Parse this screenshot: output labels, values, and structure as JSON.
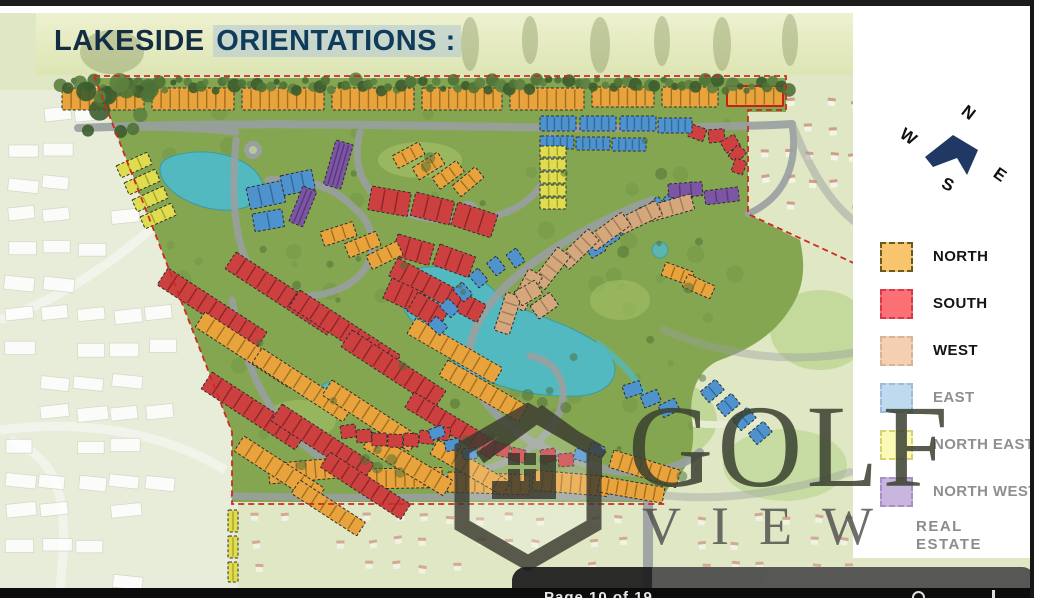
{
  "title": {
    "prefix": "LAKESIDE",
    "suffix": "ORIENTATIONS :"
  },
  "compass": {
    "arrow_color": "#1F3864",
    "letters": [
      {
        "t": "N",
        "x": 72,
        "y": 8,
        "r": 38
      },
      {
        "t": "W",
        "x": 10,
        "y": 32,
        "r": 35
      },
      {
        "t": "S",
        "x": 52,
        "y": 80,
        "r": 25
      },
      {
        "t": "E",
        "x": 104,
        "y": 70,
        "r": 35
      }
    ]
  },
  "legend": {
    "items": [
      {
        "label": "NORTH",
        "fill": "#F8C46E",
        "border": "#6b5a20",
        "label_color": "#141414"
      },
      {
        "label": "SOUTH",
        "fill": "#FA7075",
        "border": "#d93a4a",
        "label_color": "#141414"
      },
      {
        "label": "WEST",
        "fill": "#F5CFB2",
        "border": "#dbb296",
        "label_color": "#141414"
      },
      {
        "label": "EAST",
        "fill": "#BFD9EF",
        "border": "#9cbcdb",
        "label_color": "#8f8f8f"
      },
      {
        "label": "NORTH EAST",
        "fill": "#FBF9B6",
        "border": "#d8d075",
        "label_color": "#8f8f8f"
      },
      {
        "label": "NORTH WEST",
        "fill": "#C8B6DE",
        "border": "#a98fc9",
        "label_color": "#8f8f8f"
      }
    ]
  },
  "watermark": {
    "brand_top": "GOLF",
    "brand_bottom": "VIEW",
    "tagline_line1": "REAL",
    "tagline_line2": "ESTATE"
  },
  "viewer": {
    "page_label": "Page 10 of 19"
  },
  "map": {
    "palette": {
      "n": {
        "f": "#E8A33C",
        "t": "#8f6318"
      },
      "s": {
        "f": "#CC4040",
        "t": "#7e1f1f"
      },
      "w": {
        "f": "#D4A87C",
        "t": "#96714c"
      },
      "e": {
        "f": "#4E93CE",
        "t": "#28608f"
      },
      "ne": {
        "f": "#DFDC4F",
        "t": "#9a9727"
      },
      "nw": {
        "f": "#7C55A5",
        "t": "#4e3370"
      }
    },
    "clusters": [
      [
        62,
        88,
        82,
        22,
        0,
        "n",
        9
      ],
      [
        152,
        88,
        82,
        22,
        0,
        "n",
        9
      ],
      [
        242,
        88,
        82,
        22,
        0,
        "n",
        9
      ],
      [
        332,
        88,
        82,
        22,
        0,
        "n",
        9
      ],
      [
        422,
        88,
        80,
        22,
        0,
        "n",
        9
      ],
      [
        510,
        88,
        74,
        22,
        0,
        "n",
        8
      ],
      [
        592,
        87,
        62,
        20,
        0,
        "n",
        7
      ],
      [
        662,
        87,
        56,
        20,
        0,
        "n",
        6
      ],
      [
        727,
        86,
        56,
        20,
        0,
        "n",
        6,
        1
      ],
      [
        268,
        464,
        84,
        20,
        -5,
        "n",
        9
      ],
      [
        358,
        469,
        84,
        20,
        -1,
        "n",
        9
      ],
      [
        448,
        472,
        82,
        20,
        2,
        "n",
        9
      ],
      [
        534,
        470,
        76,
        20,
        5,
        "n",
        8
      ],
      [
        614,
        450,
        70,
        18,
        17,
        "n",
        7
      ],
      [
        600,
        476,
        66,
        16,
        10,
        "n",
        7
      ],
      [
        168,
        268,
        118,
        20,
        33,
        "s",
        10
      ],
      [
        236,
        252,
        122,
        20,
        33,
        "s",
        10
      ],
      [
        300,
        290,
        120,
        20,
        33,
        "s",
        10
      ],
      [
        212,
        372,
        112,
        20,
        33,
        "s",
        9
      ],
      [
        282,
        404,
        110,
        20,
        33,
        "s",
        9
      ],
      [
        352,
        330,
        112,
        20,
        33,
        "s",
        9
      ],
      [
        398,
        258,
        100,
        20,
        28,
        "s",
        8
      ],
      [
        330,
        452,
        96,
        18,
        33,
        "s",
        8
      ],
      [
        414,
        392,
        100,
        18,
        31,
        "s",
        8
      ],
      [
        205,
        312,
        110,
        18,
        33,
        "n",
        9
      ],
      [
        262,
        348,
        108,
        18,
        33,
        "n",
        9
      ],
      [
        332,
        380,
        104,
        18,
        33,
        "n",
        9
      ],
      [
        244,
        436,
        96,
        18,
        33,
        "n",
        8
      ],
      [
        372,
        432,
        94,
        18,
        31,
        "n",
        8
      ],
      [
        416,
        318,
        100,
        18,
        30,
        "n",
        8
      ],
      [
        448,
        360,
        92,
        18,
        30,
        "n",
        8
      ],
      [
        300,
        480,
        78,
        16,
        33,
        "n",
        7
      ],
      [
        438,
        440,
        84,
        16,
        30,
        "n",
        7
      ],
      [
        372,
        186,
        40,
        24,
        10,
        "s",
        3
      ],
      [
        416,
        192,
        40,
        24,
        14,
        "s",
        3
      ],
      [
        458,
        202,
        42,
        24,
        18,
        "s",
        3
      ],
      [
        398,
        234,
        38,
        22,
        16,
        "s",
        3
      ],
      [
        440,
        244,
        38,
        22,
        20,
        "s",
        3
      ],
      [
        392,
        278,
        36,
        22,
        25,
        "s",
        3
      ],
      [
        418,
        292,
        36,
        22,
        30,
        "s",
        3
      ],
      [
        692,
        124,
        16,
        13,
        20,
        "s",
        1
      ],
      [
        708,
        130,
        16,
        13,
        -5,
        "s",
        1
      ],
      [
        720,
        142,
        16,
        13,
        -30,
        "s",
        1
      ],
      [
        728,
        156,
        15,
        12,
        -50,
        "s",
        1
      ],
      [
        731,
        171,
        14,
        12,
        -70,
        "s",
        1
      ],
      [
        340,
        426,
        15,
        13,
        -8,
        "s",
        1
      ],
      [
        356,
        430,
        15,
        13,
        -4,
        "s",
        1
      ],
      [
        372,
        433,
        15,
        13,
        0,
        "s",
        1
      ],
      [
        388,
        434,
        15,
        13,
        2,
        "s",
        1
      ],
      [
        404,
        433,
        15,
        13,
        4,
        "s",
        1
      ],
      [
        420,
        430,
        15,
        13,
        6,
        "s",
        1
      ],
      [
        436,
        426,
        15,
        13,
        8,
        "s",
        1
      ],
      [
        496,
        442,
        15,
        13,
        12,
        "s",
        1
      ],
      [
        512,
        447,
        15,
        13,
        14,
        "s",
        1
      ],
      [
        540,
        450,
        15,
        13,
        -8,
        "s",
        1
      ],
      [
        558,
        454,
        15,
        13,
        -4,
        "s",
        1
      ],
      [
        540,
        116,
        36,
        15,
        0,
        "e",
        5
      ],
      [
        580,
        116,
        36,
        15,
        0,
        "e",
        5
      ],
      [
        620,
        116,
        36,
        15,
        0,
        "e",
        5
      ],
      [
        658,
        118,
        34,
        15,
        0,
        "e",
        5
      ],
      [
        540,
        136,
        34,
        13,
        0,
        "e",
        5
      ],
      [
        576,
        137,
        34,
        13,
        0,
        "e",
        5
      ],
      [
        612,
        138,
        34,
        13,
        0,
        "e",
        5
      ],
      [
        586,
        248,
        16,
        12,
        -30,
        "e",
        1
      ],
      [
        600,
        237,
        16,
        12,
        -33,
        "e",
        1
      ],
      [
        614,
        226,
        16,
        12,
        -36,
        "e",
        1
      ],
      [
        630,
        216,
        16,
        12,
        -40,
        "e",
        1
      ],
      [
        646,
        207,
        16,
        12,
        -43,
        "e",
        1
      ],
      [
        663,
        199,
        16,
        12,
        -45,
        "e",
        1
      ],
      [
        680,
        193,
        16,
        12,
        -48,
        "e",
        1
      ],
      [
        436,
        316,
        16,
        12,
        42,
        "e",
        1
      ],
      [
        448,
        298,
        16,
        12,
        45,
        "e",
        1
      ],
      [
        462,
        282,
        16,
        12,
        48,
        "e",
        1
      ],
      [
        478,
        268,
        16,
        12,
        50,
        "e",
        1
      ],
      [
        496,
        256,
        16,
        12,
        52,
        "e",
        1
      ],
      [
        516,
        248,
        16,
        12,
        55,
        "e",
        1
      ],
      [
        246,
        188,
        36,
        22,
        -12,
        "e",
        3
      ],
      [
        280,
        176,
        32,
        20,
        -12,
        "e",
        3
      ],
      [
        252,
        214,
        30,
        18,
        -10,
        "e",
        2
      ],
      [
        428,
        430,
        15,
        11,
        -20,
        "e",
        1
      ],
      [
        444,
        441,
        15,
        11,
        -12,
        "e",
        1
      ],
      [
        462,
        449,
        15,
        11,
        -6,
        "e",
        1
      ],
      [
        576,
        448,
        15,
        11,
        16,
        "e",
        1
      ],
      [
        592,
        442,
        15,
        11,
        22,
        "e",
        1
      ],
      [
        622,
        386,
        18,
        13,
        -18,
        "e",
        1
      ],
      [
        640,
        396,
        18,
        13,
        -22,
        "e",
        1
      ],
      [
        658,
        406,
        18,
        13,
        -26,
        "e",
        1
      ],
      [
        700,
        392,
        20,
        14,
        -40,
        "e",
        2
      ],
      [
        716,
        406,
        20,
        14,
        -40,
        "e",
        2
      ],
      [
        732,
        420,
        20,
        14,
        -40,
        "e",
        2
      ],
      [
        748,
        434,
        20,
        14,
        -40,
        "e",
        2
      ],
      [
        540,
        146,
        26,
        11,
        0,
        "ne",
        3
      ],
      [
        540,
        159,
        26,
        11,
        0,
        "ne",
        3
      ],
      [
        540,
        172,
        26,
        11,
        0,
        "ne",
        3
      ],
      [
        540,
        185,
        26,
        11,
        0,
        "ne",
        3
      ],
      [
        540,
        198,
        26,
        11,
        0,
        "ne",
        3
      ],
      [
        116,
        166,
        34,
        13,
        -24,
        "ne",
        3
      ],
      [
        124,
        183,
        34,
        13,
        -24,
        "ne",
        3
      ],
      [
        132,
        200,
        34,
        13,
        -24,
        "ne",
        3
      ],
      [
        140,
        217,
        34,
        13,
        -24,
        "ne",
        3
      ],
      [
        228,
        510,
        10,
        22,
        0,
        "ne",
        2
      ],
      [
        228,
        536,
        10,
        22,
        0,
        "ne",
        2
      ],
      [
        228,
        562,
        10,
        20,
        0,
        "ne",
        2
      ],
      [
        336,
        140,
        18,
        46,
        16,
        "nw",
        4
      ],
      [
        303,
        186,
        15,
        38,
        22,
        "nw",
        3
      ],
      [
        668,
        184,
        34,
        14,
        -4,
        "nw",
        3
      ],
      [
        704,
        191,
        34,
        14,
        -7,
        "nw",
        3
      ],
      [
        648,
        206,
        44,
        16,
        -16,
        "w",
        4
      ],
      [
        616,
        220,
        44,
        16,
        -26,
        "w",
        4
      ],
      [
        586,
        238,
        44,
        16,
        -36,
        "w",
        4
      ],
      [
        558,
        258,
        42,
        16,
        -44,
        "w",
        4
      ],
      [
        532,
        280,
        42,
        16,
        -52,
        "w",
        4
      ],
      [
        510,
        304,
        40,
        16,
        -62,
        "w",
        4
      ],
      [
        494,
        330,
        40,
        16,
        -72,
        "w",
        4
      ],
      [
        514,
        292,
        24,
        16,
        -30,
        "w",
        2
      ],
      [
        530,
        306,
        24,
        16,
        -35,
        "w",
        2
      ],
      [
        392,
        156,
        30,
        14,
        -28,
        "n",
        3
      ],
      [
        412,
        168,
        30,
        14,
        -32,
        "n",
        3
      ],
      [
        432,
        178,
        30,
        14,
        -36,
        "n",
        3
      ],
      [
        452,
        186,
        30,
        14,
        -40,
        "n",
        3
      ],
      [
        320,
        232,
        34,
        15,
        -18,
        "n",
        3
      ],
      [
        344,
        244,
        34,
        15,
        -22,
        "n",
        3
      ],
      [
        366,
        256,
        34,
        15,
        -26,
        "n",
        3
      ],
      [
        666,
        262,
        30,
        14,
        20,
        "n",
        3
      ],
      [
        688,
        274,
        30,
        14,
        24,
        "n",
        3
      ]
    ]
  }
}
